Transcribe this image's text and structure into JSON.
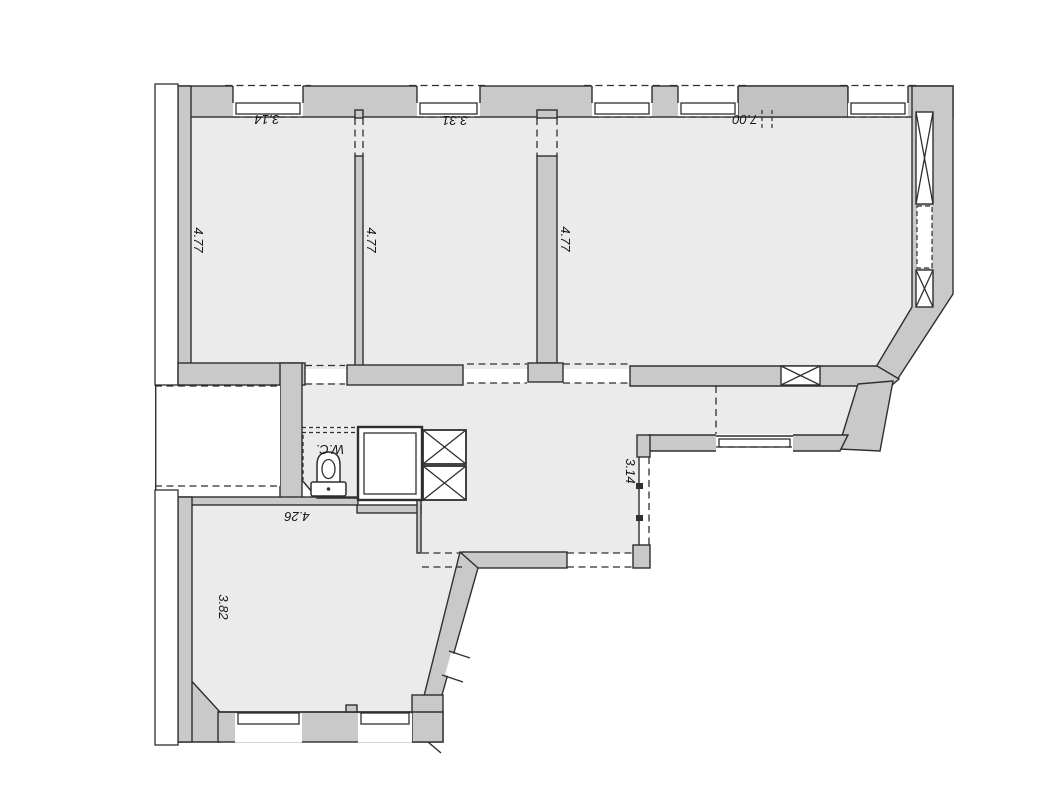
{
  "plan": {
    "type": "apartment-floor-plan",
    "colors": {
      "wall": "#c9c9c9",
      "pier": "#c2c2c2",
      "floor": "#ebebeb",
      "line": "#2f2f2f",
      "paper": "#ffffff"
    },
    "labels": {
      "room1_width": "3.14",
      "room1_depth": "4.77",
      "room2_width": "3.31",
      "room2_depth": "4.77",
      "room3_width": "7.00",
      "room3_depth": "4.77",
      "passage_width": "3.14",
      "room4_width": "4.26",
      "room4_depth": "3.82",
      "wc": "W.C."
    }
  }
}
